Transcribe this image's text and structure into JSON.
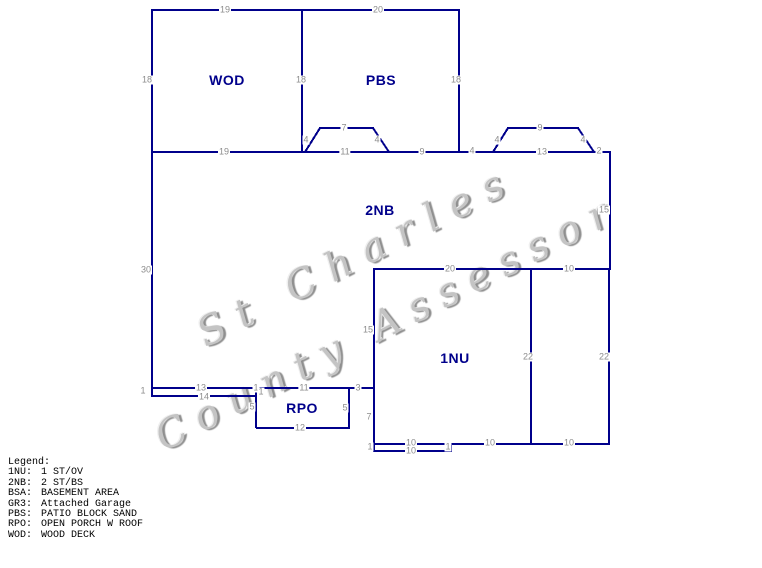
{
  "watermark": {
    "line1": "St Charles",
    "line2": "County Assessor"
  },
  "sketch": {
    "line_color": "#00008b",
    "dim_color": "#8c8c8c",
    "area_label_color": "#00008b",
    "areas": [
      {
        "label": "WOD",
        "x": 227,
        "y": 80
      },
      {
        "label": "PBS",
        "x": 381,
        "y": 80
      },
      {
        "label": "2NB",
        "x": 380,
        "y": 210
      },
      {
        "label": "1NU",
        "x": 455,
        "y": 358
      },
      {
        "label": "RPO",
        "x": 302,
        "y": 408
      }
    ],
    "dims": [
      {
        "t": "19",
        "x": 225,
        "y": 10
      },
      {
        "t": "20",
        "x": 378,
        "y": 10
      },
      {
        "t": "18",
        "x": 147,
        "y": 80
      },
      {
        "t": "18",
        "x": 301,
        "y": 80
      },
      {
        "t": "18",
        "x": 456,
        "y": 80
      },
      {
        "t": "19",
        "x": 224,
        "y": 152
      },
      {
        "t": "4",
        "x": 306,
        "y": 140
      },
      {
        "t": "7",
        "x": 344,
        "y": 128
      },
      {
        "t": "4",
        "x": 377,
        "y": 140
      },
      {
        "t": "11",
        "x": 345,
        "y": 152
      },
      {
        "t": "9",
        "x": 422,
        "y": 152
      },
      {
        "t": "4",
        "x": 472,
        "y": 151
      },
      {
        "t": "4",
        "x": 497,
        "y": 140
      },
      {
        "t": "9",
        "x": 540,
        "y": 128
      },
      {
        "t": "4",
        "x": 583,
        "y": 140
      },
      {
        "t": "13",
        "x": 542,
        "y": 152
      },
      {
        "t": "2",
        "x": 599,
        "y": 151
      },
      {
        "t": "15",
        "x": 604,
        "y": 210
      },
      {
        "t": "30",
        "x": 146,
        "y": 270
      },
      {
        "t": "20",
        "x": 450,
        "y": 269
      },
      {
        "t": "10",
        "x": 569,
        "y": 269
      },
      {
        "t": "15",
        "x": 368,
        "y": 330
      },
      {
        "t": "22",
        "x": 528,
        "y": 357
      },
      {
        "t": "22",
        "x": 604,
        "y": 357
      },
      {
        "t": "1",
        "x": 143,
        "y": 391
      },
      {
        "t": "13",
        "x": 201,
        "y": 388
      },
      {
        "t": "14",
        "x": 204,
        "y": 397
      },
      {
        "t": "1",
        "x": 256,
        "y": 388
      },
      {
        "t": "1",
        "x": 261,
        "y": 392
      },
      {
        "t": "11",
        "x": 304,
        "y": 388
      },
      {
        "t": "3",
        "x": 358,
        "y": 388
      },
      {
        "t": "5",
        "x": 252,
        "y": 407
      },
      {
        "t": "5",
        "x": 345,
        "y": 408
      },
      {
        "t": "12",
        "x": 300,
        "y": 428
      },
      {
        "t": "7",
        "x": 369,
        "y": 417
      },
      {
        "t": "10",
        "x": 411,
        "y": 443
      },
      {
        "t": "10",
        "x": 490,
        "y": 443
      },
      {
        "t": "10",
        "x": 569,
        "y": 443
      },
      {
        "t": "1",
        "x": 370,
        "y": 447
      },
      {
        "t": "10",
        "x": 411,
        "y": 451
      },
      {
        "t": "1",
        "x": 448,
        "y": 447
      }
    ],
    "lines": [
      [
        151,
        10,
        460,
        10
      ],
      [
        152,
        9,
        152,
        397
      ],
      [
        302,
        10,
        302,
        152
      ],
      [
        459,
        10,
        459,
        152
      ],
      [
        151,
        152,
        610,
        152
      ],
      [
        305,
        152,
        320,
        128
      ],
      [
        319,
        128,
        374,
        128
      ],
      [
        373,
        128,
        389,
        152
      ],
      [
        493,
        152,
        508,
        128
      ],
      [
        507,
        128,
        579,
        128
      ],
      [
        578,
        128,
        594,
        152
      ],
      [
        610,
        151,
        610,
        270
      ],
      [
        609,
        269,
        609,
        445
      ],
      [
        374,
        269,
        610,
        269
      ],
      [
        374,
        268,
        374,
        452
      ],
      [
        531,
        269,
        531,
        444
      ],
      [
        151,
        388,
        374,
        388
      ],
      [
        151,
        396,
        257,
        396
      ],
      [
        256,
        388,
        256,
        428
      ],
      [
        349,
        388,
        349,
        428
      ],
      [
        256,
        428,
        350,
        428
      ],
      [
        374,
        444,
        609,
        444
      ],
      [
        374,
        451,
        452,
        451
      ],
      [
        451,
        443,
        451,
        452
      ]
    ]
  },
  "legend": {
    "title": "Legend:",
    "entries": [
      {
        "code": "1NU:",
        "desc": "1 ST/OV"
      },
      {
        "code": "2NB:",
        "desc": "2 ST/BS"
      },
      {
        "code": "BSA:",
        "desc": "BASEMENT AREA"
      },
      {
        "code": "GR3:",
        "desc": "Attached Garage"
      },
      {
        "code": "PBS:",
        "desc": "PATIO BLOCK SAND"
      },
      {
        "code": "RPO:",
        "desc": "OPEN PORCH W ROOF"
      },
      {
        "code": "WOD:",
        "desc": "WOOD DECK"
      }
    ]
  }
}
